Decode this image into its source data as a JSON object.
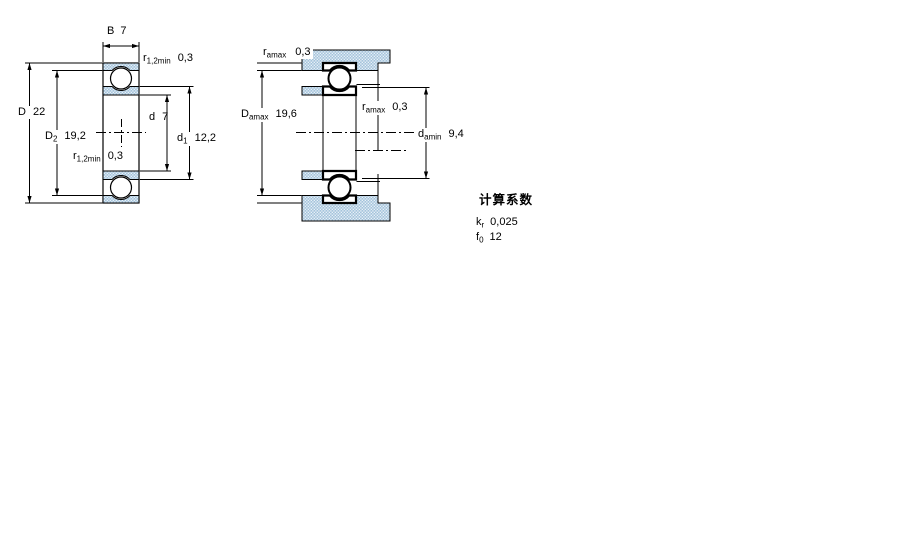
{
  "labels": {
    "left_view": {
      "b": {
        "sym": "B",
        "value": "7"
      },
      "r_top": {
        "sym": "r",
        "sub": "1,2min",
        "value": "0,3"
      },
      "d": {
        "sym": "d",
        "value": "7"
      },
      "d1": {
        "sym": "d",
        "sub": "1",
        "value": "12,2"
      },
      "D": {
        "sym": "D",
        "value": "22"
      },
      "D2": {
        "sym": "D",
        "sub": "2",
        "value": "19,2"
      },
      "r_bottom": {
        "sym": "r",
        "sub": "1,2min",
        "value": "0,3"
      }
    },
    "right_view": {
      "ra_top": {
        "sym": "r",
        "sub": "amax",
        "value": "0,3"
      },
      "Da": {
        "sym": "D",
        "sub": "amax",
        "value": "19,6"
      },
      "ra_mid": {
        "sym": "r",
        "sub": "amax",
        "value": "0,3"
      },
      "da": {
        "sym": "d",
        "sub": "amin",
        "value": "9,4"
      }
    },
    "calculation_factors": {
      "title": "计算系数",
      "kr": {
        "sym": "k",
        "sub": "r",
        "value": "0,025"
      },
      "f0": {
        "sym": "f",
        "sub": "0",
        "value": "12"
      }
    }
  },
  "colors": {
    "section_fill_base": "#a5c4dc",
    "section_fill_dot": "#eaf2f8",
    "line": "#000000",
    "background": "#ffffff"
  }
}
